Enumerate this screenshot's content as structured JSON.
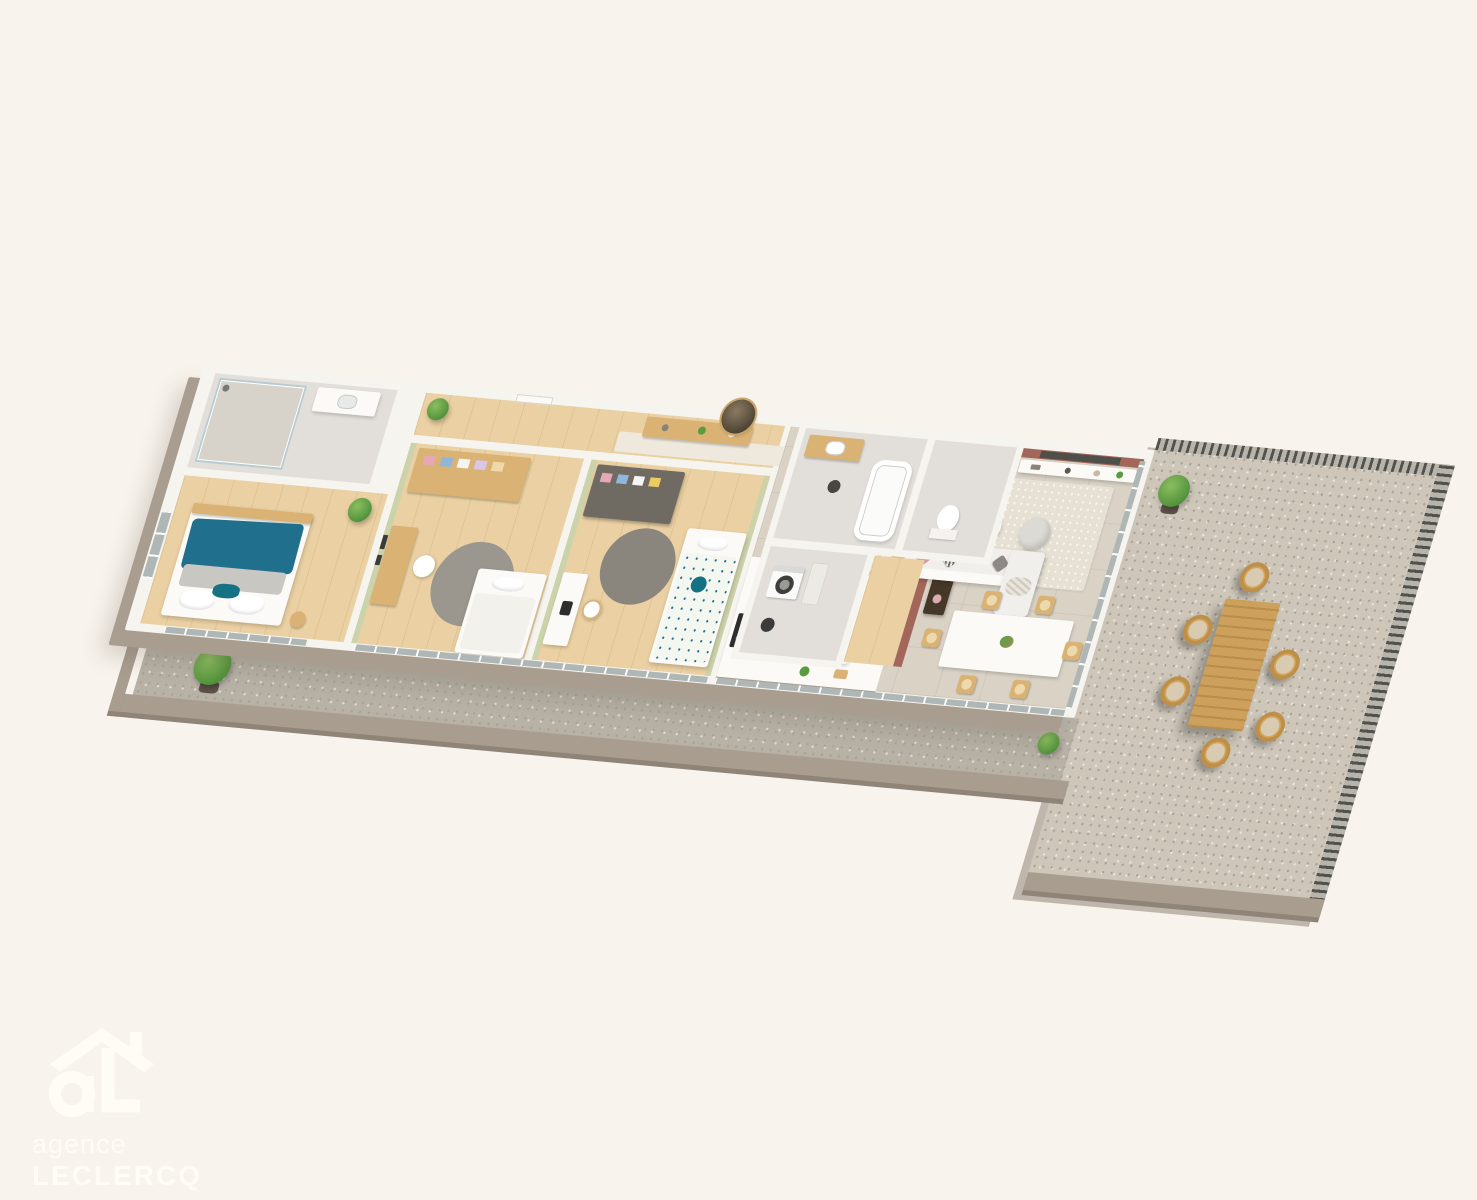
{
  "scene": {
    "kind": "3d-floor-plan-render",
    "subject": "apartment-floor-plan-with-balcony-and-terrace",
    "background": "#f8f3ec"
  },
  "watermark": {
    "logo": "agency-house-logo",
    "line1": "agence",
    "line2": "LECLERCQ"
  },
  "palette": {
    "bg": "#f8f3ec",
    "wm": "#fffdf6",
    "wallWhite": "#f6f4ef",
    "wallShade": "#a99d90",
    "wallShadeDark": "#8f8478",
    "oak": "#ead0a2",
    "tile": "#d9d2c5",
    "greyFloor": "#e2dfda",
    "sage": "#ccd3ab",
    "terracotta": "#a2665a",
    "tvDark": "#4e4f4a",
    "teal": "#20708d",
    "tealDeep": "#157184",
    "greyRug": "#9b968e",
    "darkRug": "#8a857d",
    "beigeRug": "#e7e1d4",
    "wood": "#d9b274",
    "darkWood": "#463828",
    "pink": "#d29a9b",
    "plant": "#5a9a40",
    "plantDark": "#3f7e2f",
    "potBrown": "#5d5148",
    "gravel": "#cdc6b9",
    "gravelDark": "#b7b1a6",
    "gravelSpeck": "#a8a195",
    "fence": "#52514b",
    "fenceLight": "#b7b4ac",
    "glass": "#aeb6b6",
    "outdoorWood": "#cda05b"
  },
  "rooms": [
    {
      "name": "en-suite-shower-room",
      "floor": "grey",
      "items": [
        "walk-in-shower",
        "glass-screen",
        "washbasin-vanity"
      ]
    },
    {
      "name": "master-bedroom",
      "floor": "oak",
      "items": [
        "double-bed",
        "teal-duvet",
        "grey-throw",
        "pillows",
        "bedside-table",
        "window",
        "potted-plant"
      ]
    },
    {
      "name": "bedroom-2",
      "floor": "oak",
      "items": [
        "open-wardrobe",
        "folded-clothes",
        "desk",
        "chair",
        "wall-frames",
        "round-grey-rug",
        "single-bed"
      ]
    },
    {
      "name": "bedroom-3",
      "floor": "oak",
      "items": [
        "dark-wardrobe",
        "folded-clothes",
        "desk",
        "chair",
        "round-dark-rug",
        "bed-floral-bedding",
        "teal-round-cushion"
      ]
    },
    {
      "name": "entrance-hall",
      "floor": "oak",
      "items": [
        "entry-door",
        "console-sideboard",
        "round-mirror",
        "runner-rug",
        "potted-plant"
      ]
    },
    {
      "name": "bathroom",
      "floor": "grey",
      "items": [
        "wood-vanity-washbasin",
        "bathtub",
        "stool"
      ]
    },
    {
      "name": "wc",
      "floor": "grey",
      "items": [
        "toilet"
      ]
    },
    {
      "name": "laundry-closet",
      "floor": "grey",
      "items": [
        "washing-machine",
        "shelving",
        "robot-vacuum"
      ]
    },
    {
      "name": "kitchen",
      "floor": "tile",
      "items": [
        "wall-counter",
        "induction-hob",
        "base-cabinets",
        "island-with-sink",
        "counter-plant"
      ]
    },
    {
      "name": "dining-area",
      "floor": "tile",
      "items": [
        "white-dining-table",
        "six-wooden-chairs",
        "table-centerpiece"
      ]
    },
    {
      "name": "living-room",
      "floor": "tile",
      "items": [
        "terracotta-accent-wall",
        "tv-niche",
        "long-low-shelf",
        "shelf-decor",
        "tall-plant",
        "armchair",
        "dark-coffee-table",
        "white-coffee-table",
        "lounge-pouf",
        "sofa-with-cushions",
        "chaise-extension",
        "area-rug",
        "dark-sideboard"
      ]
    },
    {
      "name": "balcony",
      "floor": "gravel",
      "items": [
        "potted-shrub",
        "boxwood-ball",
        "parapet",
        "glazed-doors"
      ]
    },
    {
      "name": "terrace",
      "floor": "gravel",
      "items": [
        "outdoor-dining-table",
        "six-rattan-chairs",
        "potted-plant",
        "slatted-fence-top",
        "slatted-fence-right",
        "parapet"
      ]
    }
  ]
}
